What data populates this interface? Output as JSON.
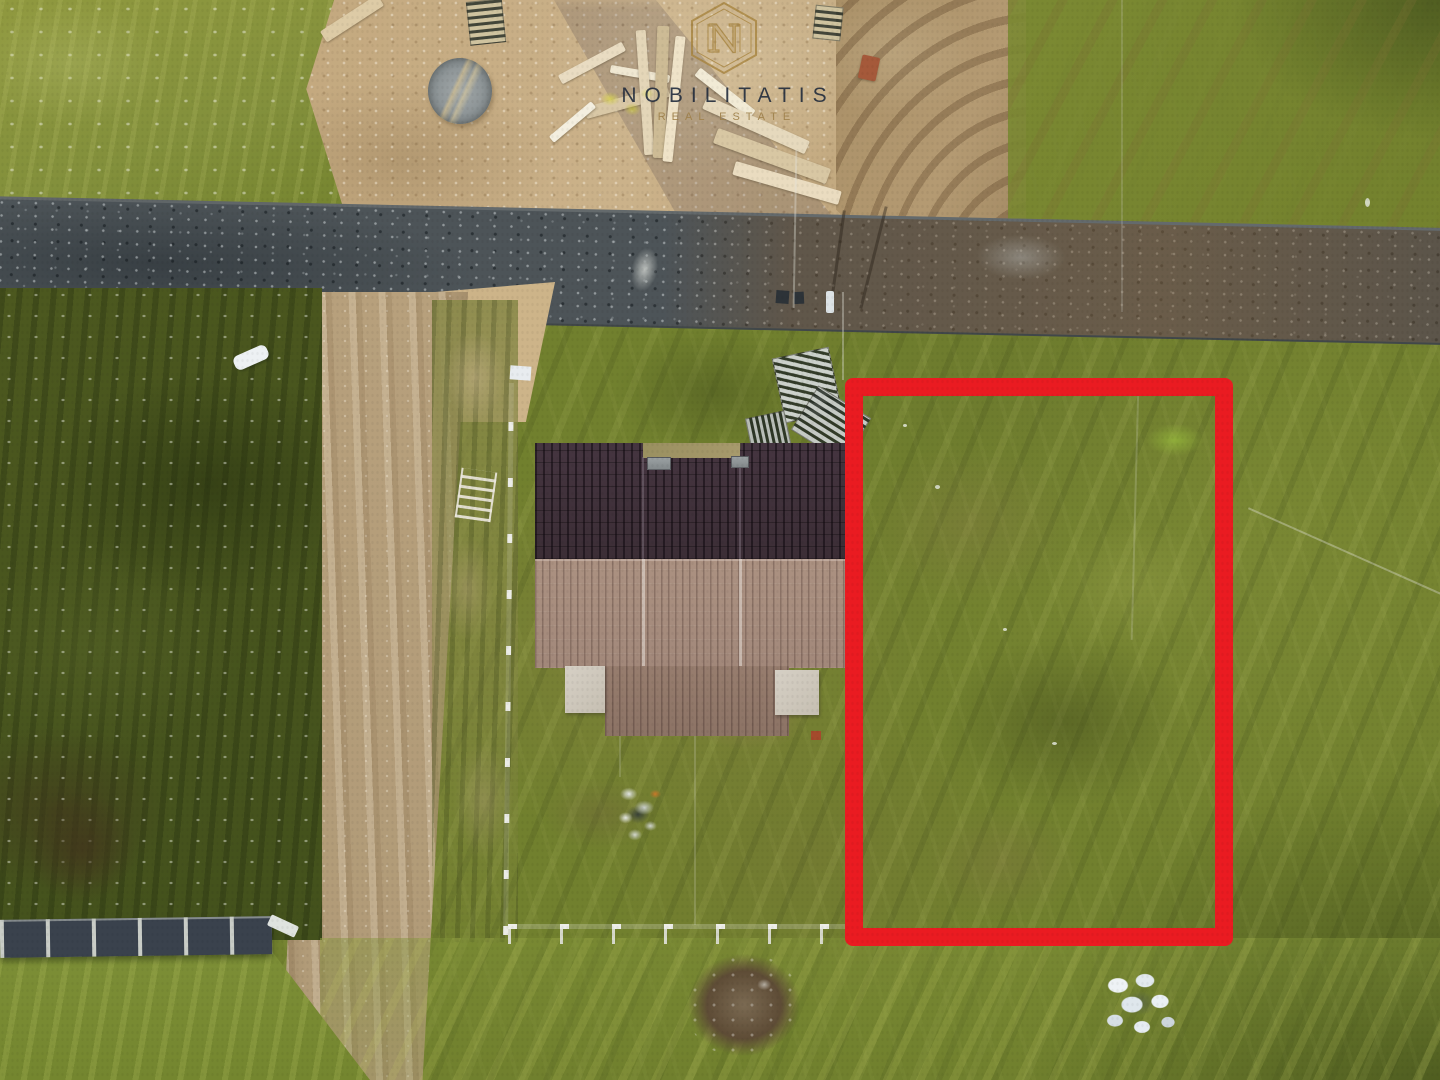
{
  "meta": {
    "kind": "aerial drone photograph",
    "width_px": 1440,
    "height_px": 1080
  },
  "watermark": {
    "brand": "NOBILITATIS",
    "tagline": "REAL ESTATE",
    "logo_letter": "N",
    "brand_color": "#1c2840",
    "gold_color": "#9e804a"
  },
  "annotation": {
    "label": "advertised vacant plot boundary",
    "outline_color": "#ea1b21"
  },
  "scene": {
    "description": "Top-down aerial photo of a rural development: a gravel road crossing horizontally, a dirt side road running down-left, a sandy construction yard with lumber piles and a concrete circle, a house with a two-tone brown tiled roof inside a white post fence, dark shrubby parcel on the left, and a grassy vacant parcel on the right outlined with a thick red rectangle.",
    "elements": [
      "grass-field",
      "gravel-road",
      "dirt-side-road",
      "construction-sand-yard",
      "lumber-piles",
      "wooden-pallets",
      "concrete-circle-pad",
      "tiled-roof-house",
      "porch-roof",
      "white-post-fence",
      "dark-panel-wall",
      "shrub-parcel",
      "debris-pile",
      "burnt-ground-patch",
      "white-sack-pile",
      "tyre-tracks",
      "plot-boundary-highlight",
      "brand-watermark"
    ]
  }
}
